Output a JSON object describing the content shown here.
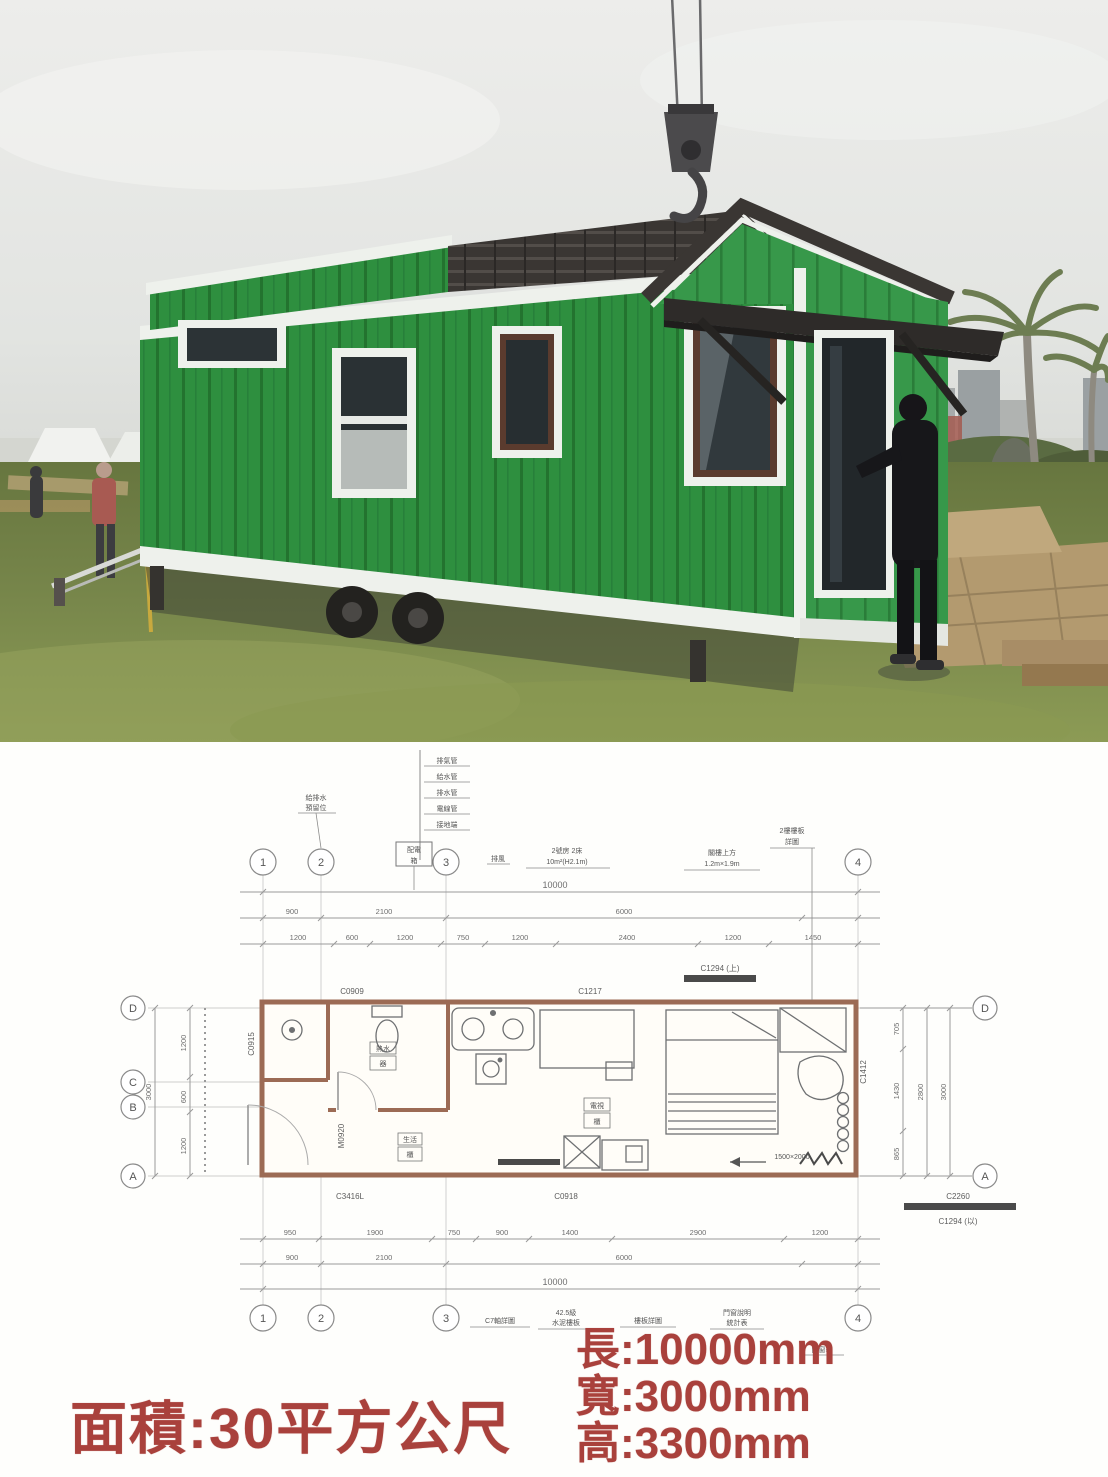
{
  "colors": {
    "accent_red": "#a9413c",
    "house_green": "#2e8f3f",
    "gable_green": "#3a9a4a",
    "trim_white": "#eef1ec",
    "roof_dark": "#3a3633",
    "grass_green": "#76854a",
    "sky_gray": "#e9eae8",
    "plan_wall_brown": "#9c6b55"
  },
  "plan": {
    "grid_columns": [
      "1",
      "2",
      "3",
      "4"
    ],
    "grid_rows": [
      "D",
      "C",
      "B",
      "A"
    ],
    "dims": {
      "top_overall": "10000",
      "top_mid": [
        "900",
        "2100",
        "6000"
      ],
      "top_detail": [
        "1200",
        "600",
        "1200",
        "750",
        "1200",
        "2400",
        "1200",
        "1450"
      ],
      "bottom_overall": "10000",
      "bottom_mid": [
        "900",
        "2100",
        "6000"
      ],
      "bottom_detail": [
        "950",
        "1900",
        "750",
        "900",
        "1400",
        "2900",
        "1200"
      ],
      "left_overall": "3000",
      "left_detail": [
        "1200",
        "600",
        "1200"
      ],
      "right_overall": "3000",
      "right_mid": "2800",
      "right_detail": [
        "705",
        "1430",
        "865"
      ]
    },
    "tags": {
      "c0909": "C0909",
      "c1217": "C1217",
      "c0915": "C0915",
      "c1294_top": "C1294 (上)",
      "c3416l": "C3416L",
      "c0918": "C0918",
      "c2260": "C2260",
      "c1294_bottom": "C1294 (以)",
      "m0920": "M0920",
      "c1412": "C1412",
      "bed_note": "1500×2000"
    },
    "callouts": {
      "stack": [
        "排氣管",
        "給水管",
        "排水管",
        "電線管",
        "接地端"
      ],
      "above_col2": [
        "給排水",
        "預留位"
      ],
      "flag_box": [
        "配電",
        "箱"
      ],
      "small_note": "排風",
      "mid_note": [
        "2號房 2床",
        "10m²(H2.1m)"
      ],
      "right_note1": [
        "閣樓上方",
        "1.2m×1.9m"
      ],
      "right_note2": [
        "2樓樓板",
        "詳圖"
      ],
      "bottom_note1": "C7軸詳圖",
      "bottom_note2": [
        "42.5級",
        "水泥樓板"
      ],
      "bottom_note3": "樓板詳圖",
      "bottom_note4": [
        "門窗說明",
        "統計表"
      ],
      "side_note": "門窗表"
    },
    "room_boxes": {
      "bath": [
        "熱水",
        "器"
      ],
      "hall": [
        "生活",
        "櫃"
      ],
      "living": [
        "電視",
        "櫃"
      ]
    }
  },
  "footer": {
    "area": "面積:30平方公尺",
    "length": "長:10000mm",
    "width": "寬:3000mm",
    "height": "高:3300mm"
  }
}
